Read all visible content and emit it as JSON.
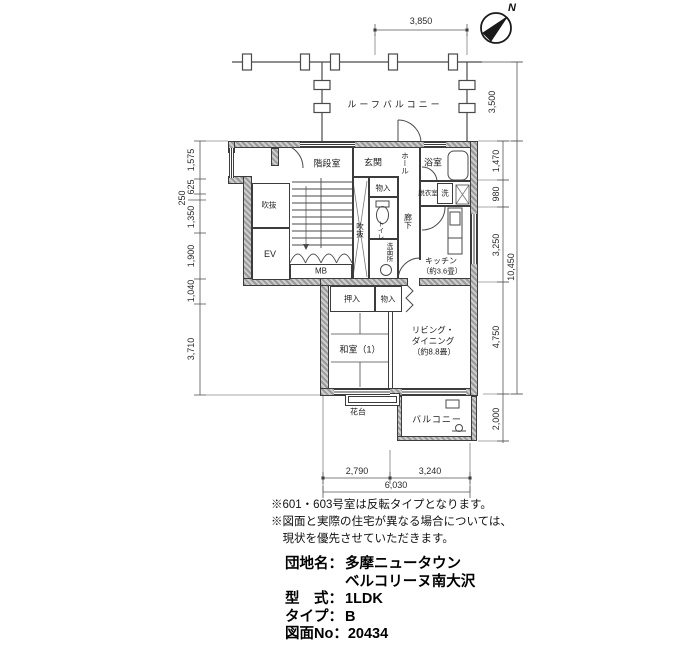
{
  "colors": {
    "background": "#ffffff",
    "line": "#3c3c3c",
    "wall_fill": "#b5b5b5"
  },
  "compass": {
    "label": "N"
  },
  "rooms": {
    "roof_balcony": "ルーフバルコニー",
    "stairwell": "階段室",
    "entrance": "玄関",
    "hall": "ホール",
    "bath": "浴室",
    "storage_upper": "物入",
    "dressing": "脱衣室",
    "laundry": "洗",
    "void_left": "吹抜",
    "void_center": "吹抜",
    "ev": "EV",
    "mb": "MB",
    "toilet": "トイレ",
    "washroom": "洗面所",
    "corridor": "廊下",
    "kitchen": "キッチン",
    "kitchen_size": "（約3.6畳）",
    "oshiire": "押入",
    "storage_lower": "物入",
    "washitsu": "和室（1）",
    "living_1": "リビング・",
    "living_2": "ダイニング",
    "living_size": "（約8.8畳）",
    "hanadai": "花台",
    "balcony": "バルコニー"
  },
  "dimensions": {
    "top": [
      "3,850"
    ],
    "left": [
      "1,575",
      "625",
      "250",
      "1,350",
      "1,900",
      "1,040",
      "3,710"
    ],
    "right": [
      "3,500",
      "1,470",
      "980",
      "3,250",
      "10,450",
      "4,750",
      "2,000"
    ],
    "bottom": [
      "2,790",
      "3,240",
      "6,030"
    ]
  },
  "notes": [
    "※601・603号室は反転タイプとなります。",
    "※図面と実際の住宅が異なる場合については、",
    "　現状を優先させていただきます。"
  ],
  "info": {
    "rows": [
      {
        "label": "団地名：",
        "value": "多摩ニュータウン"
      },
      {
        "label": "",
        "value": "ベルコリーヌ南大沢"
      },
      {
        "label": "型　式：",
        "value": "1LDK"
      },
      {
        "label": "タイプ：",
        "value": "B"
      },
      {
        "label": "図面No：",
        "value": "20434"
      }
    ]
  }
}
